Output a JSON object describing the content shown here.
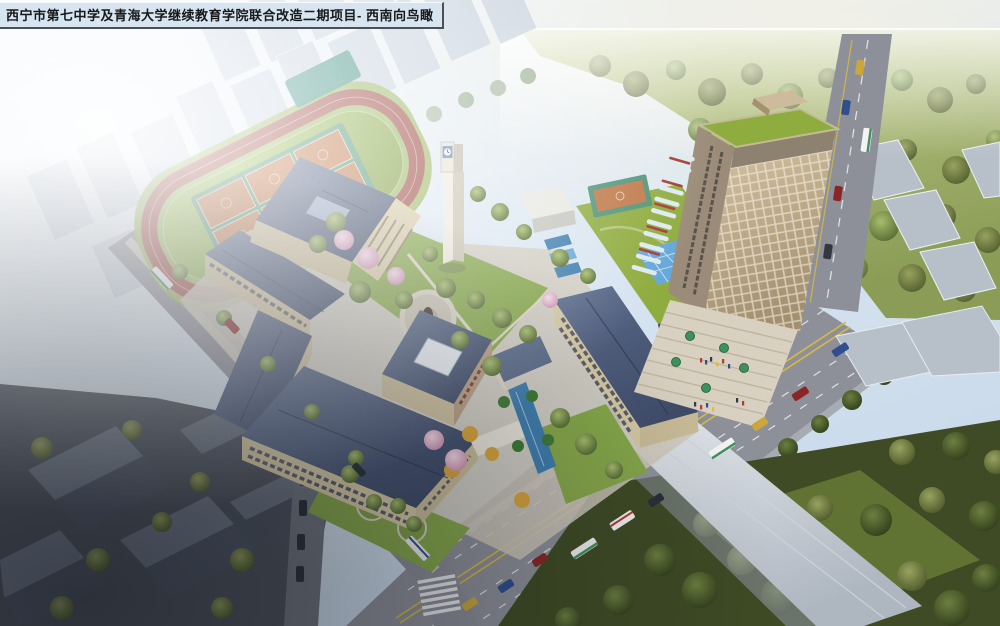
{
  "title_bar": {
    "text": "西宁市第七中学及青海大学继续教育学院联合改造二期项目- 西南向鸟瞰"
  },
  "scene": {
    "view": "aerial-birdseye-rendering",
    "palette": {
      "sky_haze": "#eef4f9",
      "track_red": "#9e4b44",
      "field_green": "#8fae4a",
      "court_orange": "#bf7747",
      "court_teal": "#4f9377",
      "pool_teal": "#3d8f83",
      "roof_slate": "#49587a",
      "wall_beige": "#d6c9a4",
      "road_gray": "#8e9099",
      "marking_yellow": "#d9ba3e",
      "tower_tan": "#c0ae90",
      "tower_green_roof": "#8fac3e",
      "accent_red": "#a63c30",
      "water_blue": "#3f7fae",
      "glass_blue": "#66a8da",
      "tree_green": "#6d8738",
      "tree_dark": "#45562a",
      "blossom_pink": "#e3b4c8",
      "plaza_beige": "#d8d0c0",
      "old_town_gray": "#5c6470"
    },
    "landmarks": [
      {
        "name": "running-track"
      },
      {
        "name": "basketball-courts"
      },
      {
        "name": "auditorium"
      },
      {
        "name": "teaching-buildings"
      },
      {
        "name": "clock-tower"
      },
      {
        "name": "statue-plaza"
      },
      {
        "name": "entrance-water-feature"
      },
      {
        "name": "green-roof-podium"
      },
      {
        "name": "highrise-tower"
      },
      {
        "name": "entry-steps-plaza"
      },
      {
        "name": "main-avenue"
      },
      {
        "name": "side-street"
      },
      {
        "name": "hazy-city-background"
      },
      {
        "name": "park-woodland"
      }
    ]
  }
}
